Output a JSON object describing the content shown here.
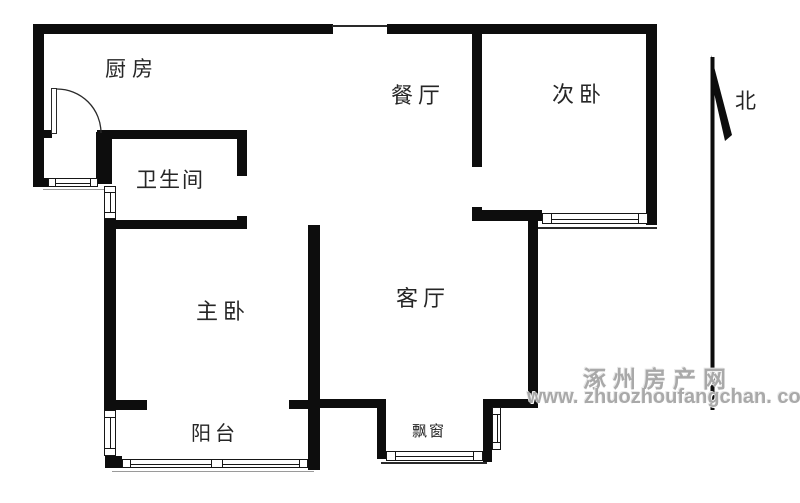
{
  "plan": {
    "rooms": {
      "kitchen": "厨房",
      "dining_room": "餐厅",
      "second_bedroom": "次卧",
      "bathroom": "卫生间",
      "master_bedroom": "主卧",
      "living_room": "客厅",
      "balcony": "阳台",
      "bay_window": "飘窗"
    },
    "compass": {
      "north": "北"
    }
  },
  "watermark": {
    "site_name": "涿州房产网",
    "url": "www. zhuozhoufangchan. com"
  },
  "colors": {
    "background": "#ffffff",
    "wall": "#0d0d0d",
    "label_text": "#262626",
    "watermark_gray": "#a9a9a9"
  }
}
